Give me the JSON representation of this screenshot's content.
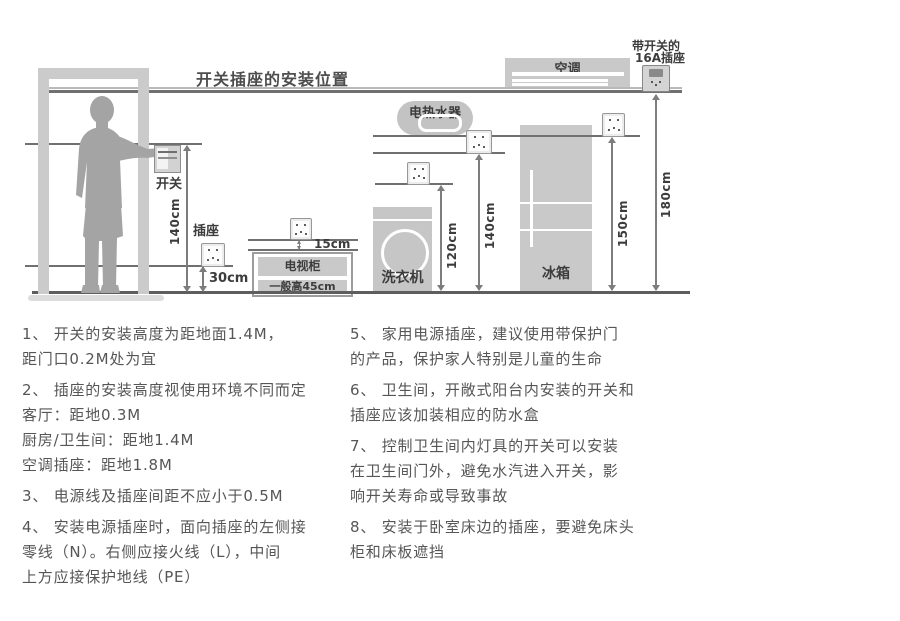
{
  "title": "开关插座的安装位置",
  "diagram": {
    "door_area": {
      "switch_label": "开关",
      "socket_label": "插座",
      "dim_switch": "140cm",
      "dim_socket": "30cm"
    },
    "tv": {
      "name": "电视柜",
      "height_note": "一般高45cm",
      "dim_gap": "15cm"
    },
    "washer": {
      "name": "洗衣机",
      "dim": "120cm"
    },
    "heater": {
      "name": "电热水器",
      "dim": "140cm"
    },
    "fridge": {
      "name": "冰箱",
      "dim": "150cm"
    },
    "ac": {
      "name": "空调",
      "dim": "180cm",
      "socket_note_line1": "带开关的",
      "socket_note_line2": "16A插座"
    }
  },
  "notes": {
    "left": [
      {
        "lines": [
          "1、 开关的安装高度为距地面1.4M，",
          "距门口0.2M处为宜"
        ]
      },
      {
        "lines": [
          "2、 插座的安装高度视使用环境不同而定",
          "客厅：距地0.3M",
          "厨房/卫生间：距地1.4M",
          "空调插座：距地1.8M"
        ]
      },
      {
        "lines": [
          "3、 电源线及插座间距不应小于0.5M"
        ]
      },
      {
        "lines": [
          "4、 安装电源插座时，面向插座的左侧接",
          "零线（N）。右侧应接火线（L），中间",
          "上方应接保护地线（PE）"
        ]
      }
    ],
    "right": [
      {
        "lines": [
          "5、 家用电源插座，建议使用带保护门",
          "的产品，保护家人特别是儿童的生命"
        ]
      },
      {
        "lines": [
          "6、 卫生间，开敞式阳台内安装的开关和",
          "插座应该加装相应的防水盒"
        ]
      },
      {
        "lines": [
          "7、 控制卫生间内灯具的开关可以安装",
          "在卫生间门外，避免水汽进入开关，影",
          "响开关寿命或导致事故"
        ]
      },
      {
        "lines": [
          "8、 安装于卧室床边的插座，要避免床头",
          "柜和床板遮挡"
        ]
      }
    ]
  },
  "colors": {
    "figure_grey": "#a4a4a4",
    "appliance_grey": "#c9c9c9",
    "line_grey": "#707070",
    "ground_grey": "#5e5e5e",
    "note_text": "#565656",
    "label_dark": "#3c3c3c"
  }
}
